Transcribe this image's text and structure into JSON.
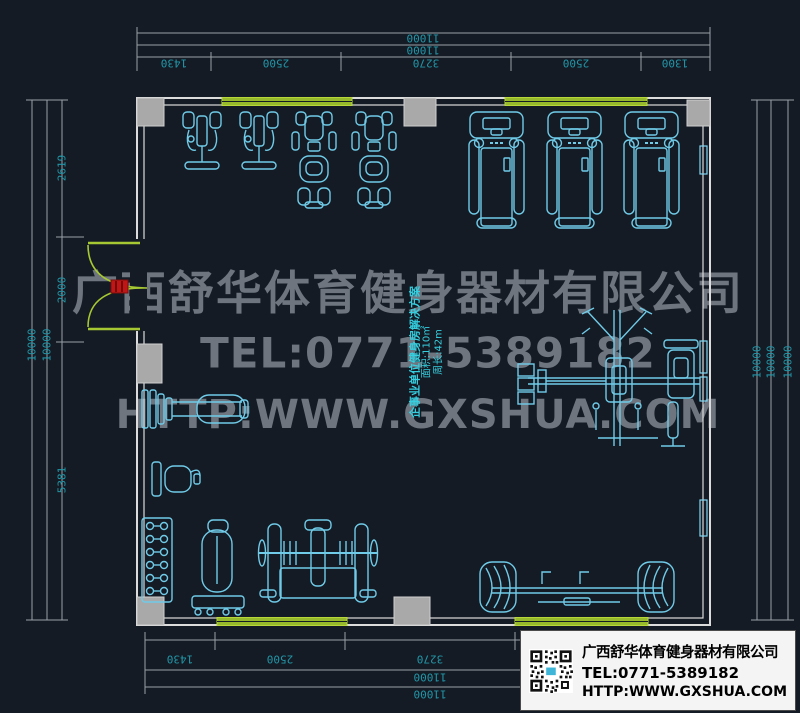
{
  "title": "gym-floor-plan-cad-drawing",
  "watermark": {
    "company": "广西舒华体育健身器材有限公司",
    "tel": "TEL:0771-5389182",
    "url": "HTTP:WWW.GXSHUA.COM"
  },
  "annotation": {
    "line1": "企事业单位健身房解决方案",
    "area": "面积:110㎡",
    "perimeter": "周长:42m"
  },
  "dimensions": {
    "top": {
      "total_outer": "11000",
      "total_inner": "11000",
      "segments": [
        "1430",
        "2500",
        "3270",
        "2500",
        "1300"
      ]
    },
    "bottom": {
      "segments": [
        "1430",
        "2500",
        "3270"
      ],
      "total_inner": "11000",
      "total_outer": "11000"
    },
    "left": {
      "segments": [
        "2619",
        "2000",
        "5381"
      ],
      "totals": [
        "10000",
        "10000"
      ]
    },
    "right": {
      "totals": [
        "10000",
        "10000",
        "10000"
      ]
    }
  },
  "info_box": {
    "company": "广西舒华体育健身器材有限公司",
    "tel": "TEL:0771-5389182",
    "url": "HTTP:WWW.GXSHUA.COM"
  },
  "equipment_icons": [
    "shoulder-press-machine",
    "shoulder-press-machine",
    "recumbent-bike",
    "recumbent-bike",
    "treadmill",
    "treadmill",
    "treadmill",
    "multi-station-trainer",
    "plate-loaded-bench",
    "chair",
    "dumbbell-rack",
    "standing-unit",
    "bench-press-rack",
    "dual-end-bench-station"
  ],
  "colors": {
    "background": "#151b24",
    "equipment_cyan": "#6fcbe8",
    "dimension_text": "#2196a8",
    "wall_green": "#a6c832",
    "wall_line": "#dcdcdc",
    "column_gray": "#a9a9a9",
    "door_red": "#c11616",
    "watermark_gray": "#7b828c"
  }
}
